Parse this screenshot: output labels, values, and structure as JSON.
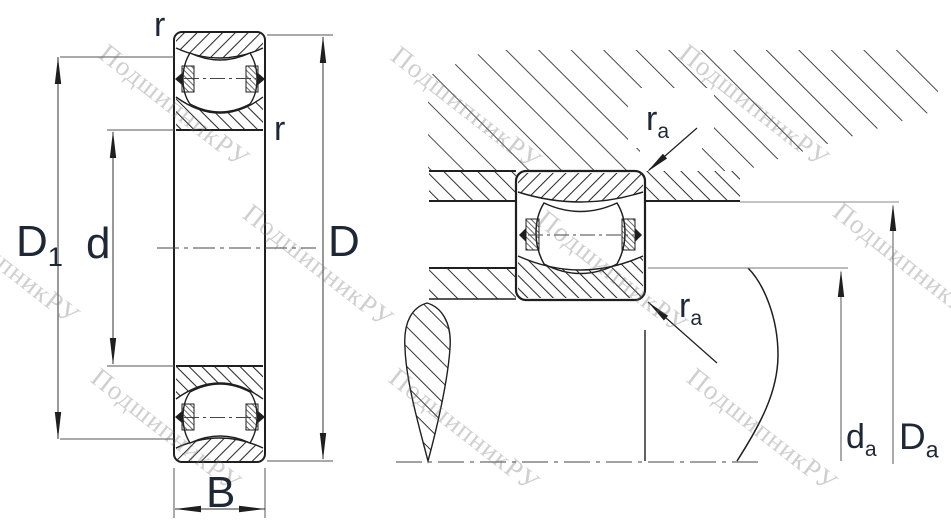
{
  "drawing": {
    "type": "bearing-technical-drawing",
    "watermark_text": "ПодшипникРУ",
    "left_view": {
      "description": "bearing cross-section with boundary dimensions",
      "labels": {
        "r_top": "r",
        "r_inner": "r",
        "D1": {
          "main": "D",
          "sub": "1"
        },
        "d": "d",
        "D": "D",
        "B": "B"
      }
    },
    "right_view": {
      "description": "mounted bearing with abutment dimensions",
      "labels": {
        "ra_top": {
          "main": "r",
          "sub": "a"
        },
        "ra_bottom": {
          "main": "r",
          "sub": "a"
        },
        "da": {
          "main": "d",
          "sub": "a"
        },
        "Da": {
          "main": "D",
          "sub": "a"
        }
      }
    },
    "colors": {
      "background": "#ffffff",
      "outline": "#1f1f1f",
      "dimension_line": "#444444",
      "label": "#1d2736",
      "watermark": "#737373"
    }
  }
}
